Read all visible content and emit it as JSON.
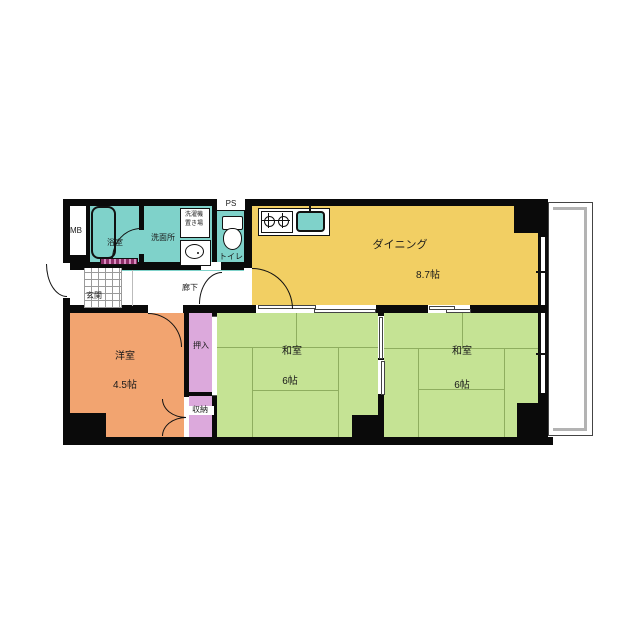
{
  "floorplan": {
    "title": "apartment-floor-plan",
    "labels": {
      "meter_box": "MB",
      "pipe_space": "PS",
      "bath": "浴室",
      "washroom": "洗面所",
      "laundry_line1": "洗濯機",
      "laundry_line2": "置き場",
      "toilet": "トイレ",
      "entrance": "玄関",
      "corridor": "廊下",
      "dining": "ダイニング",
      "dining_size": "8.7帖",
      "western_room": "洋室",
      "western_room_size": "4.5帖",
      "closet": "押入",
      "storage": "収納",
      "japanese_room1": "和室",
      "japanese_room1_size": "6帖",
      "japanese_room2": "和室",
      "japanese_room2_size": "6帖"
    },
    "colors": {
      "dining_floor": "#F2CF63",
      "tatami_floor": "#C5E394",
      "western_floor": "#F2A470",
      "wet_area_floor": "#7FD2CA",
      "closet_floor": "#DCA9DC",
      "wall": "#0a0a0a",
      "balcony_rail": "#b3b3b3"
    }
  }
}
